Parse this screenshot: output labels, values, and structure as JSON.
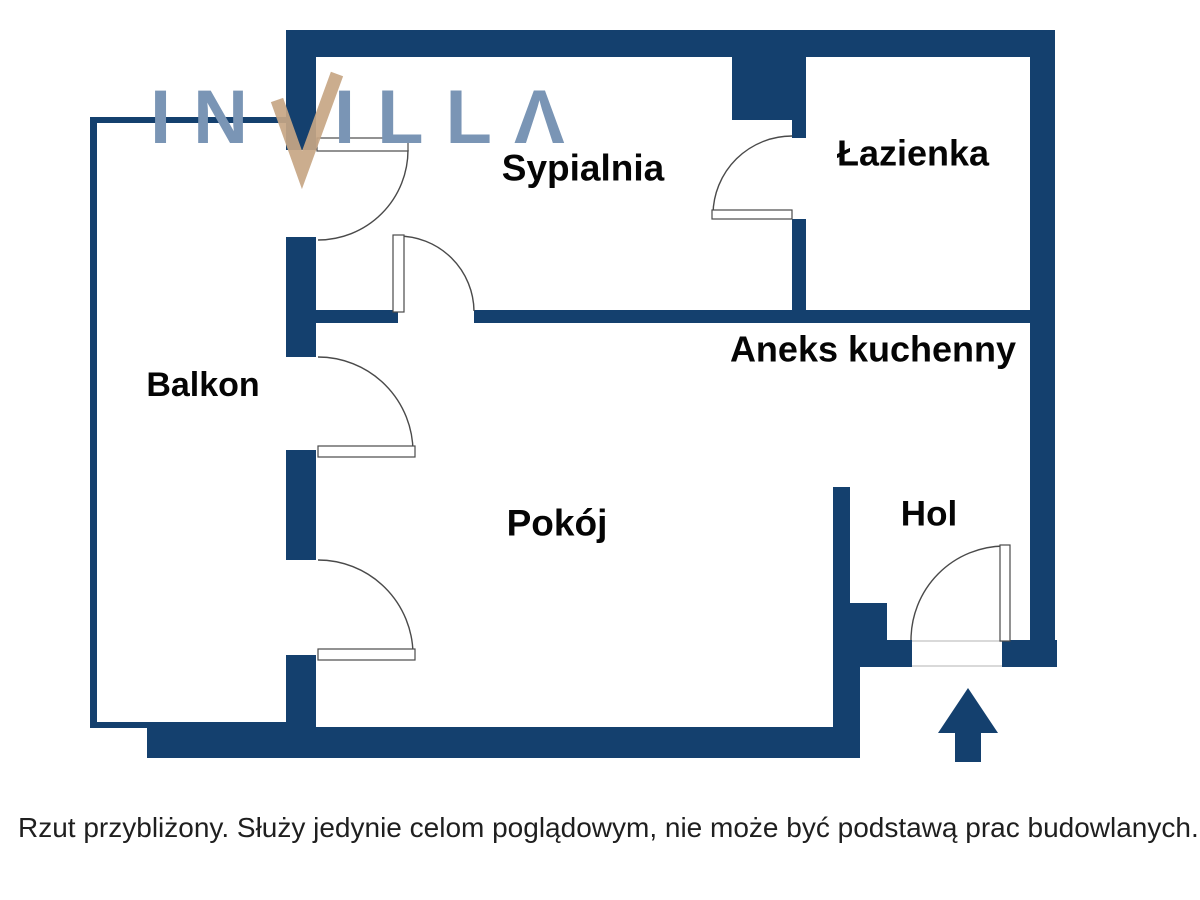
{
  "colors": {
    "wall": "#14406e",
    "arc": "#4a4a4a",
    "leaf_fill": "#ffffff",
    "threshold": "#d9d9d9",
    "label": "#050505",
    "logo_blue": "#7a95b5",
    "logo_tan": "#c7a684",
    "disclaimer": "#1f1f1f"
  },
  "logo": {
    "left_text": "IN",
    "check_letter": "V",
    "right_text": "ILLΛ"
  },
  "disclaimer": "Rzut przybliżony. Służy jedynie celom poglądowym, nie może być podstawą prac budowlanych.",
  "rooms": [
    {
      "id": "sypialnia",
      "label": "Sypialnia",
      "cx": 583,
      "cy": 168,
      "size": 37
    },
    {
      "id": "lazienka",
      "label": "Łazienka",
      "cx": 913,
      "cy": 153,
      "size": 36
    },
    {
      "id": "aneks-kuchenny",
      "label": "Aneks kuchenny",
      "cx": 873,
      "cy": 349,
      "size": 36
    },
    {
      "id": "balkon",
      "label": "Balkon",
      "cx": 203,
      "cy": 385,
      "size": 34
    },
    {
      "id": "pokoj",
      "label": "Pokój",
      "cx": 557,
      "cy": 523,
      "size": 37
    },
    {
      "id": "hol",
      "label": "Hol",
      "cx": 929,
      "cy": 514,
      "size": 35
    }
  ],
  "floorplan": {
    "walls": [
      {
        "name": "top-wall",
        "x": 286,
        "y": 30,
        "w": 769,
        "h": 27
      },
      {
        "name": "left-wall-upper",
        "x": 286,
        "y": 30,
        "w": 30,
        "h": 120
      },
      {
        "name": "left-wall-mid-1",
        "x": 286,
        "y": 237,
        "w": 30,
        "h": 120
      },
      {
        "name": "left-wall-mid-2",
        "x": 286,
        "y": 450,
        "w": 30,
        "h": 110
      },
      {
        "name": "left-wall-lower",
        "x": 286,
        "y": 655,
        "w": 30,
        "h": 102
      },
      {
        "name": "right-wall",
        "x": 1030,
        "y": 30,
        "w": 25,
        "h": 637
      },
      {
        "name": "bath-entry-pier",
        "x": 732,
        "y": 57,
        "w": 74,
        "h": 63
      },
      {
        "name": "bath-wall-upper",
        "x": 792,
        "y": 120,
        "w": 14,
        "h": 18
      },
      {
        "name": "bath-wall-lower",
        "x": 792,
        "y": 219,
        "w": 14,
        "h": 103
      },
      {
        "name": "divider-wall-left",
        "x": 316,
        "y": 310,
        "w": 82,
        "h": 13
      },
      {
        "name": "divider-wall-right",
        "x": 474,
        "y": 310,
        "w": 556,
        "h": 13
      },
      {
        "name": "hol-partition",
        "x": 833,
        "y": 487,
        "w": 17,
        "h": 120
      },
      {
        "name": "hol-step",
        "x": 833,
        "y": 603,
        "w": 54,
        "h": 37
      },
      {
        "name": "hol-connector",
        "x": 833,
        "y": 640,
        "w": 27,
        "h": 117
      },
      {
        "name": "entry-wall-left",
        "x": 860,
        "y": 640,
        "w": 52,
        "h": 27
      },
      {
        "name": "entry-wall-right",
        "x": 1002,
        "y": 640,
        "w": 55,
        "h": 27
      },
      {
        "name": "bottom-wall",
        "x": 147,
        "y": 727,
        "w": 713,
        "h": 31
      },
      {
        "name": "balcony-wall-left",
        "x": 90,
        "y": 117,
        "w": 7,
        "h": 611
      },
      {
        "name": "balcony-wall-top",
        "x": 90,
        "y": 117,
        "w": 196,
        "h": 6
      },
      {
        "name": "balcony-wall-bottom",
        "x": 90,
        "y": 722,
        "w": 196,
        "h": 6
      }
    ],
    "thresholds": [
      {
        "name": "entrance-threshold-top",
        "x": 912,
        "y": 640,
        "w": 90,
        "h": 2
      },
      {
        "name": "entrance-threshold-bottom",
        "x": 912,
        "y": 665,
        "w": 90,
        "h": 2
      }
    ],
    "doors": [
      {
        "name": "sypialnia-balcony-door",
        "leaf": {
          "x": 317,
          "y": 138,
          "w": 91,
          "h": 13
        },
        "arc": {
          "x1": 408,
          "y1": 150,
          "x2": 318,
          "y2": 240,
          "r": 90,
          "sweep": 1
        }
      },
      {
        "name": "pokoj-balcony-door-1",
        "leaf": {
          "x": 318,
          "y": 446,
          "w": 97,
          "h": 11
        },
        "arc": {
          "x1": 318,
          "y1": 357,
          "x2": 413,
          "y2": 452,
          "r": 95,
          "sweep": 1
        }
      },
      {
        "name": "pokoj-balcony-door-2",
        "leaf": {
          "x": 318,
          "y": 649,
          "w": 97,
          "h": 11
        },
        "arc": {
          "x1": 318,
          "y1": 560,
          "x2": 413,
          "y2": 654,
          "r": 95,
          "sweep": 1
        }
      },
      {
        "name": "sypialnia-interior-door",
        "leaf": {
          "x": 393,
          "y": 235,
          "w": 11,
          "h": 77
        },
        "arc": {
          "x1": 398,
          "y1": 236,
          "x2": 474,
          "y2": 311,
          "r": 76,
          "sweep": 1
        }
      },
      {
        "name": "bathroom-door",
        "leaf": {
          "x": 712,
          "y": 210,
          "w": 80,
          "h": 9
        },
        "arc": {
          "x1": 713,
          "y1": 214,
          "x2": 792,
          "y2": 136,
          "r": 79,
          "sweep": 1
        }
      },
      {
        "name": "entrance-door",
        "leaf": {
          "x": 1000,
          "y": 545,
          "w": 10,
          "h": 96
        },
        "arc": {
          "x1": 1004,
          "y1": 546,
          "x2": 911,
          "y2": 640,
          "r": 94,
          "sweep": 0
        }
      }
    ],
    "arrow": {
      "points": "955,762 955,733 938,733 968,688 998,733 981,733 981,762"
    }
  }
}
